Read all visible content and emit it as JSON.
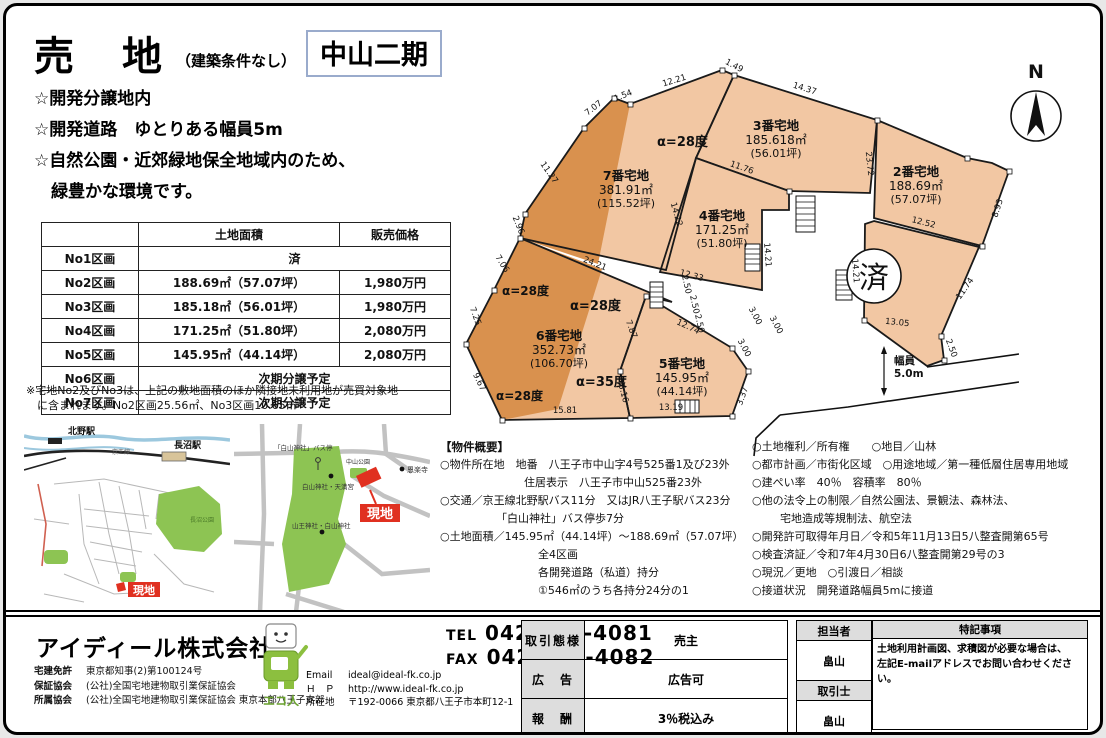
{
  "header": {
    "title": "売　地",
    "subtitle": "（建築条件なし）",
    "project": "中山二期"
  },
  "highlights": {
    "line1": "☆開発分譲地内",
    "line2": "☆開発道路　ゆとりある幅員5m",
    "line3": "☆自然公園・近郊緑地保全地域内のため、",
    "line4": "　緑豊かな環境です。"
  },
  "price_table": {
    "headers": {
      "no": "",
      "area": "土地面積",
      "price": "販売価格"
    },
    "r1": {
      "no": "No1区画",
      "merged": "済"
    },
    "r2": {
      "no": "No2区画",
      "area": "188.69㎡（57.07坪）",
      "price": "1,980万円"
    },
    "r3": {
      "no": "No3区画",
      "area": "185.18㎡（56.01坪）",
      "price": "1,980万円"
    },
    "r4": {
      "no": "No4区画",
      "area": "171.25㎡（51.80坪）",
      "price": "2,080万円"
    },
    "r5": {
      "no": "No5区画",
      "area": "145.95㎡（44.14坪）",
      "price": "2,080万円"
    },
    "r6": {
      "no": "No6区画",
      "merged": "次期分譲予定"
    },
    "r7": {
      "no": "No7区画",
      "merged": "次期分譲予定"
    }
  },
  "note": {
    "line1": "※宅地No2及びNo3は、上記の敷地面積のほか隣接地未利用地が売買対象地",
    "line2": "　に含まれます。No2区画25.56㎡、No3区画10.65㎡"
  },
  "maps": {
    "left": {
      "station1": "北野駅",
      "station2": "長沼駅",
      "rail": "京王線",
      "park": "長沼公園",
      "site": "現地"
    },
    "right": {
      "bus_stop": "「白山神社」バス停",
      "shrine1": "白山神社・天満宮",
      "shrine2": "山王神社・白山神社",
      "park": "中山公園",
      "temple": "恩楽寺",
      "site": "現地"
    }
  },
  "plot_map": {
    "compass": "N",
    "sold": "済",
    "road_width": {
      "line1": "幅員",
      "line2": "5.0m"
    },
    "parcels": {
      "p7": {
        "name": "7番宅地",
        "area": "381.91㎡",
        "tsubo": "(115.52坪)"
      },
      "p3": {
        "name": "3番宅地",
        "area": "185.618㎡",
        "tsubo": "(56.01坪)"
      },
      "p2": {
        "name": "2番宅地",
        "area": "188.69㎡",
        "tsubo": "(57.07坪)"
      },
      "p4": {
        "name": "4番宅地",
        "area": "171.25㎡",
        "tsubo": "(51.80坪)"
      },
      "p6": {
        "name": "6番宅地",
        "area": "352.73㎡",
        "tsubo": "(106.70坪)"
      },
      "p5": {
        "name": "5番宅地",
        "area": "145.95㎡",
        "tsubo": "(44.14坪)"
      }
    },
    "angles": [
      "α=28度",
      "α=28度",
      "α=28度",
      "α=28度",
      "α=35度"
    ],
    "edges": [
      "7.07",
      "1.54",
      "12.21",
      "1.49",
      "14.37",
      "11.27",
      "2.96",
      "7.06",
      "7.25",
      "9.67",
      "15.81",
      "24.21",
      "14.22",
      "11.76",
      "23.72",
      "12.33",
      "12.74",
      "7.87",
      "5.16",
      "13.19",
      "3.37",
      "3.00",
      "3.00",
      "2.50",
      "2.50",
      "2.50",
      "2.50",
      "12.52",
      "8.93",
      "11.74",
      "13.05",
      "14.21",
      "14.21",
      "3.00"
    ]
  },
  "overview": {
    "title": "【物件概要】",
    "left": [
      "○物件所在地　地番　八王子市中山字4号525番1及び23外",
      "住居表示　八王子市中山525番23外",
      "○交通／京王線北野駅バス11分　又はJR八王子駅バス23分",
      "「白山神社」バス停歩7分",
      "○土地面積／145.95㎡（44.14坪）～188.69㎡（57.07坪）",
      "全4区画",
      "各開発道路（私道）持分",
      "①546㎡のうち各持分24分の1"
    ],
    "right": [
      "○土地権利／所有権　　○地目／山林",
      "○都市計画／市街化区域　○用途地域／第一種低層住居専用地域",
      "○建ぺい率　40％　容積率　80％",
      "○他の法令上の制限／自然公園法、景観法、森林法、",
      "宅地造成等規制法、航空法",
      "○開発許可取得年月日／令和5年11月13日5八整査開第65号",
      "○検査済証／令和7年4月30日6八整査開第29号の3",
      "○現況／更地　○引渡日／相談",
      "○接道状況　開発道路幅員5mに接道"
    ]
  },
  "footer": {
    "company": "アイディール株式会社",
    "license": [
      {
        "label": "宅建免許",
        "value": "東京都知事(2)第100124号"
      },
      {
        "label": "保証協会",
        "value": "(公社)全国宅地建物取引業保証協会"
      },
      {
        "label": "所属協会",
        "value": "(公社)全国宅地建物取引業保証協会 東京本部八王子支部"
      }
    ],
    "mascot": "エコ人",
    "tel_label": "TEL",
    "tel": "042-649-4081",
    "fax_label": "FAX",
    "fax": "042-649-4082",
    "contact": [
      {
        "label": "Email",
        "value": "ideal@ideal-fk.co.jp"
      },
      {
        "label": "Ｈ　Ｐ",
        "value": "http://www.ideal-fk.co.jp"
      },
      {
        "label": "所在地",
        "value": "〒192-0066 東京都八王子市本町12-1"
      }
    ],
    "deal": [
      {
        "label": "取引態様",
        "value": "売主"
      },
      {
        "label": "広　告",
        "value": "広告可"
      },
      {
        "label": "報　酬",
        "value": "3％税込み"
      }
    ],
    "staff": {
      "h1": "担当者",
      "v1": "畠山",
      "h2": "取引士",
      "v2": "畠山"
    },
    "remarks": {
      "title": "特記事項",
      "line1": "土地利用計画図、求積図が必要な場合は、",
      "line2": "左記E-mailアドレスでお問い合わせください。"
    }
  }
}
